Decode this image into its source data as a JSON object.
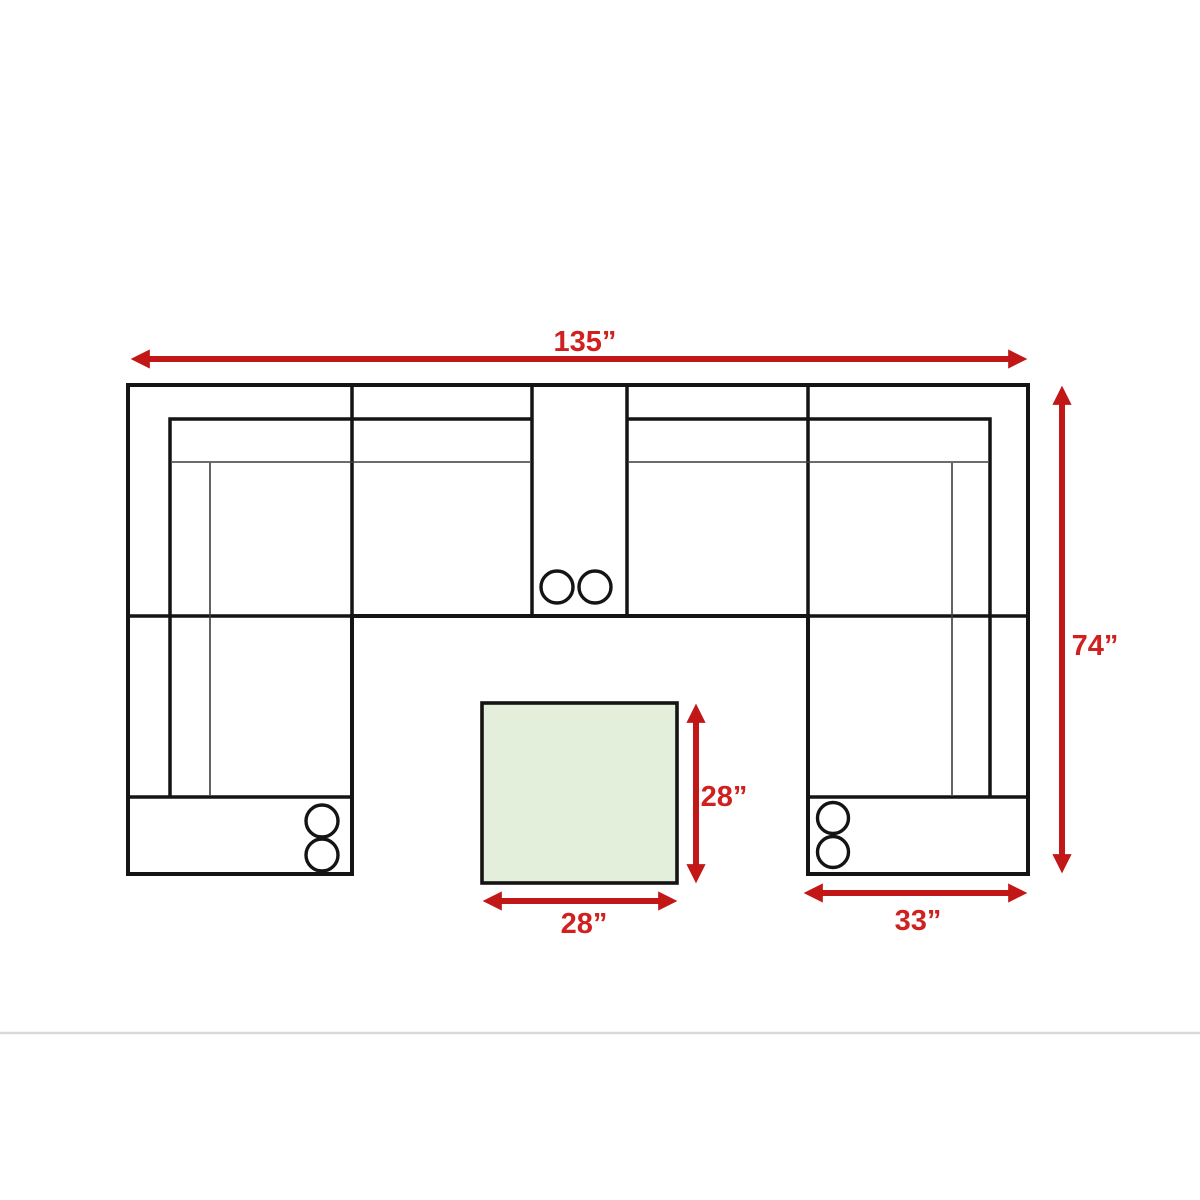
{
  "page": {
    "background": "#ffffff"
  },
  "diagram": {
    "type": "sectional-sofa-floor-plan",
    "unit": "inches",
    "labels": {
      "total_width": "135”",
      "total_depth": "74”",
      "ottoman_depth": "28”",
      "ottoman_width": "28”",
      "right_chaise_width": "33”"
    },
    "measurements": {
      "total_width_in": 135,
      "total_depth_in": 74,
      "ottoman_width_in": 28,
      "ottoman_depth_in": 28,
      "right_chaise_width_in": 33
    },
    "features": {
      "console_cupholders": 2,
      "left_chaise_cupholders": 2,
      "right_chaise_cupholders": 2
    },
    "colors": {
      "dimension_red": "#c21717",
      "label_red": "#d02020",
      "ottoman_green": "#e3eedb",
      "outline_black": "#141414",
      "footer_divider_gray": "#d9d9d9"
    }
  }
}
